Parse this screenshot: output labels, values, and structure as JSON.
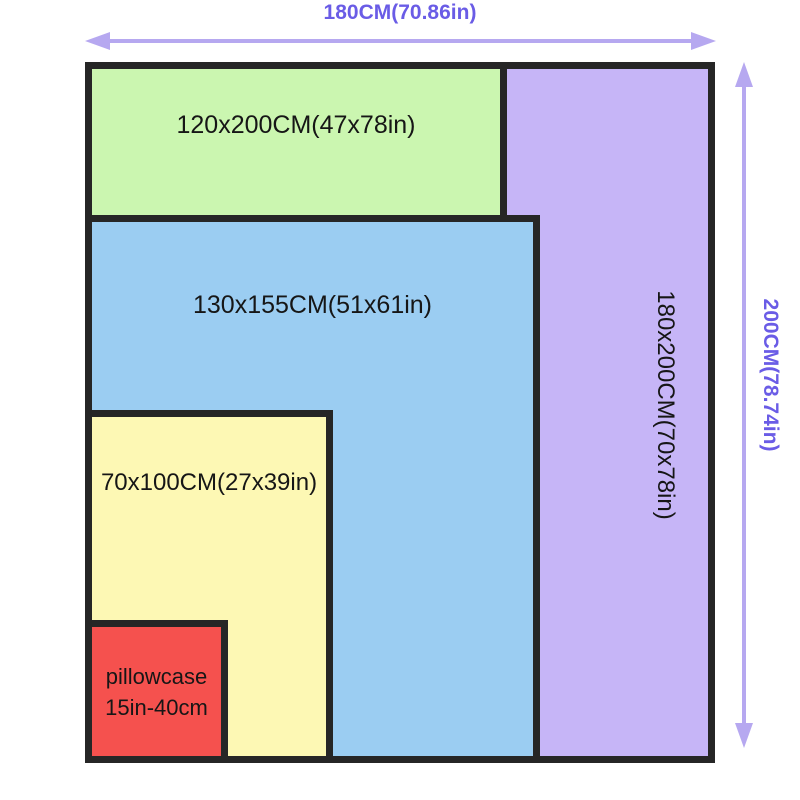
{
  "dimensions": {
    "top": "180CM(70.86in)",
    "right": "200CM(78.74in)"
  },
  "rects": {
    "purple": {
      "label": "180x200CM(70x78in)",
      "color": "#c6b5f7"
    },
    "green": {
      "label": "120x200CM(47x78in)",
      "color": "#cbf6b0"
    },
    "blue": {
      "label": "130x155CM(51x61in)",
      "color": "#9bcdf2"
    },
    "yellow": {
      "label": "70x100CM(27x39in)",
      "color": "#fdf8b4"
    },
    "red": {
      "label_line1": "pillowcase",
      "label_line2": "15in-40cm",
      "color": "#f5514e"
    }
  },
  "icons": {
    "horizontal_arrow": "double-headed-arrow",
    "vertical_arrow": "double-headed-arrow"
  },
  "colors": {
    "background": "#ffffff",
    "border": "#262626",
    "label-text": "#161616",
    "dimension-text": "#6a5ce6",
    "arrow": "#b6a8f0"
  }
}
